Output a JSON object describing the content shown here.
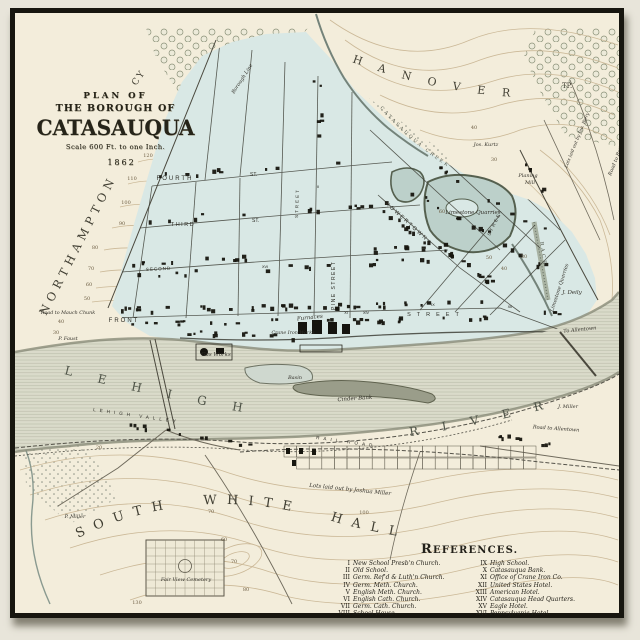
{
  "map": {
    "title_block": {
      "plan_of": "PLAN OF",
      "borough_of": "THE BOROUGH OF",
      "name": "CATASAUQUA",
      "scale": "Scale 600 Ft. to one Inch.",
      "year": "1862"
    },
    "regions": {
      "hanover": "HANOVER",
      "hanover_tp": "TP.",
      "northampton": "NORTHAMPTON",
      "northampton_cy": "CY",
      "south_white_hall": "SOUTH WHITE HALL",
      "borough_line": "Borough Line"
    },
    "water": {
      "lehigh": "LEHIGH",
      "river": "RIVER",
      "creek": "CATASAUQUA CREEK",
      "race": "RACE",
      "basin": "Basin",
      "cinder_bank": "Cinder Bank"
    },
    "railroads": {
      "lehigh_valley": "LEHIGH VALLEY",
      "rail_road": "RAIL ROAD"
    },
    "streets": {
      "fourth": "FOURTH",
      "fourth_st": "ST.",
      "third": "THIRD",
      "third_st": "ST.",
      "second": "SECOND",
      "front": "FRONT",
      "front_street": "STREET",
      "pine_street": "PINE STREET",
      "howertown": "HOWERTOWN",
      "street_a": "STREET",
      "street_b": "STREET"
    },
    "places": {
      "limestone_quarries_1": "Limestone Quarries",
      "limestone_quarries_2": "Limestone Quarries",
      "planing_1": "Planing",
      "planing_2": "Mill",
      "jos_kurtz": "Jos. Kurtz",
      "lots_biery": "Lots laid out by Jno. Biery",
      "road_bethlehem": "Road to Bethlehem",
      "j_deily": "J. Deily",
      "to_allentown": "To Allentown",
      "j_miller": "J. Miller",
      "road_allentown": "Road to Allentown",
      "gas_works": "Gas Works",
      "furnaces": "Furnaces",
      "crane_iron_works": "Crane Iron Works",
      "road_mauch_chunk": "Road to Mauch Chunk",
      "p_faust": "P. Faust",
      "p_miller": "P. Miller",
      "fair_view_cemetery": "Fair View Cemetery",
      "lots_miller": "Lots laid out by Joshua Miller"
    },
    "contour_numbers": [
      "120",
      "110",
      "100",
      "90",
      "80",
      "70",
      "60",
      "50",
      "40",
      "30",
      "60",
      "50",
      "40",
      "30",
      "40",
      "30",
      "20",
      "70",
      "60",
      "70",
      "80",
      "100",
      "130"
    ],
    "building_numerals": [
      "II",
      "XVI",
      "XI",
      "XIV",
      "IX",
      "XII"
    ],
    "references": {
      "title": "REFERENCES.",
      "left": [
        {
          "n": "I",
          "t": "New School Presb'n Church."
        },
        {
          "n": "II",
          "t": "Old School."
        },
        {
          "n": "III",
          "t": "Germ. Ref'd & Luth'n Church."
        },
        {
          "n": "IV",
          "t": "Germ. Meth. Church."
        },
        {
          "n": "V",
          "t": "English Meth. Church."
        },
        {
          "n": "VI",
          "t": "English Cath. Church."
        },
        {
          "n": "VII",
          "t": "Germ. Cath. Church."
        },
        {
          "n": "VIII",
          "t": "School House."
        }
      ],
      "right": [
        {
          "n": "IX",
          "t": "High School."
        },
        {
          "n": "X",
          "t": "Catasauqua Bank."
        },
        {
          "n": "XI",
          "t": "Office of Crane Iron Co."
        },
        {
          "n": "XII",
          "t": "United States Hotel."
        },
        {
          "n": "XIII",
          "t": "American Hotel."
        },
        {
          "n": "XIV",
          "t": "Catasauqua Head Quarters."
        },
        {
          "n": "XV",
          "t": "Eagle Hotel."
        },
        {
          "n": "XVI",
          "t": "Pennsylvania Hotel."
        }
      ]
    },
    "colors": {
      "paper": "#f3eddb",
      "borough": "#d9e8e5",
      "river": "#dadbca",
      "pond": "#bcd0ca",
      "ink": "#2c2a21",
      "contour": "#c9b694",
      "frame": "#17160f"
    }
  }
}
